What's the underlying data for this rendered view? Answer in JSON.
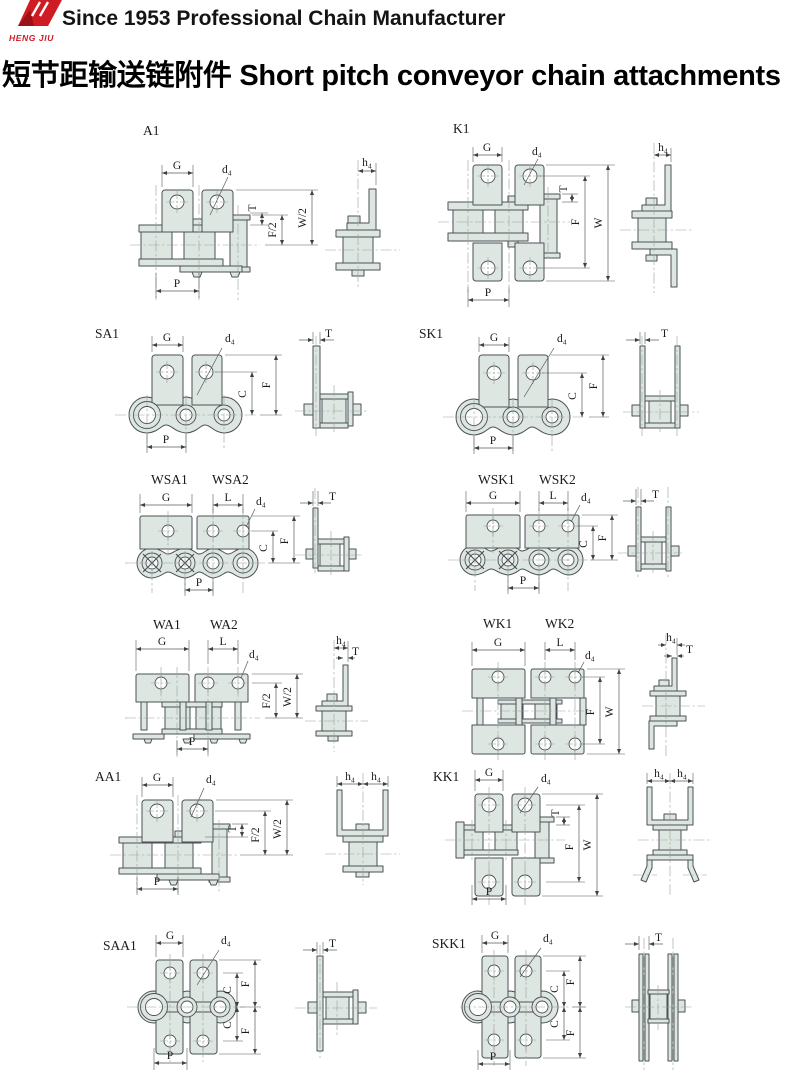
{
  "header": {
    "logo_text": "HENG JIU",
    "tagline": "Since 1953 Professional Chain Manufacturer"
  },
  "title": {
    "zh": "短节距输送链附件",
    "en": "Short pitch conveyor chain attachments"
  },
  "dim_labels": {
    "G": "G",
    "L": "L",
    "T": "T",
    "F": "F",
    "W": "W",
    "C": "C",
    "P": "P",
    "F2": "F/2",
    "W2": "W/2",
    "d4": "d₄",
    "h4": "h₄"
  },
  "diagrams": [
    {
      "id": "A1",
      "names": [
        "A1"
      ],
      "dims": [
        "G",
        "d₄",
        "T",
        "F/2",
        "W/2",
        "P",
        "h₄"
      ]
    },
    {
      "id": "K1",
      "names": [
        "K1"
      ],
      "dims": [
        "G",
        "d₄",
        "T",
        "F",
        "W",
        "P",
        "h₄"
      ]
    },
    {
      "id": "SA1",
      "names": [
        "SA1"
      ],
      "dims": [
        "G",
        "d₄",
        "C",
        "F",
        "P",
        "T"
      ]
    },
    {
      "id": "SK1",
      "names": [
        "SK1"
      ],
      "dims": [
        "G",
        "d₄",
        "C",
        "F",
        "P",
        "T"
      ]
    },
    {
      "id": "WSA",
      "names": [
        "WSA1",
        "WSA2"
      ],
      "dims": [
        "G",
        "L",
        "d₄",
        "C",
        "F",
        "P",
        "T"
      ]
    },
    {
      "id": "WSK",
      "names": [
        "WSK1",
        "WSK2"
      ],
      "dims": [
        "G",
        "L",
        "d₄",
        "C",
        "F",
        "P",
        "T"
      ]
    },
    {
      "id": "WA",
      "names": [
        "WA1",
        "WA2"
      ],
      "dims": [
        "G",
        "L",
        "d₄",
        "F/2",
        "W/2",
        "P",
        "h₄",
        "T"
      ]
    },
    {
      "id": "WK",
      "names": [
        "WK1",
        "WK2"
      ],
      "dims": [
        "G",
        "L",
        "d₄",
        "F",
        "W",
        "h₄",
        "T"
      ]
    },
    {
      "id": "AA1",
      "names": [
        "AA1"
      ],
      "dims": [
        "G",
        "d₄",
        "T",
        "F/2",
        "W/2",
        "P",
        "h₄",
        "h₄"
      ]
    },
    {
      "id": "KK1",
      "names": [
        "KK1"
      ],
      "dims": [
        "G",
        "d₄",
        "T",
        "F",
        "W",
        "P",
        "h₄",
        "h₄"
      ]
    },
    {
      "id": "SAA1",
      "names": [
        "SAA1"
      ],
      "dims": [
        "G",
        "d₄",
        "C",
        "F",
        "C",
        "F",
        "P",
        "T"
      ]
    },
    {
      "id": "SKK1",
      "names": [
        "SKK1"
      ],
      "dims": [
        "G",
        "d₄",
        "C",
        "F",
        "C",
        "F",
        "P",
        "T"
      ]
    }
  ],
  "colors": {
    "accent_red": "#cf1c24",
    "plate_fill": "#dee6e1",
    "line_color": "#4b5156"
  }
}
